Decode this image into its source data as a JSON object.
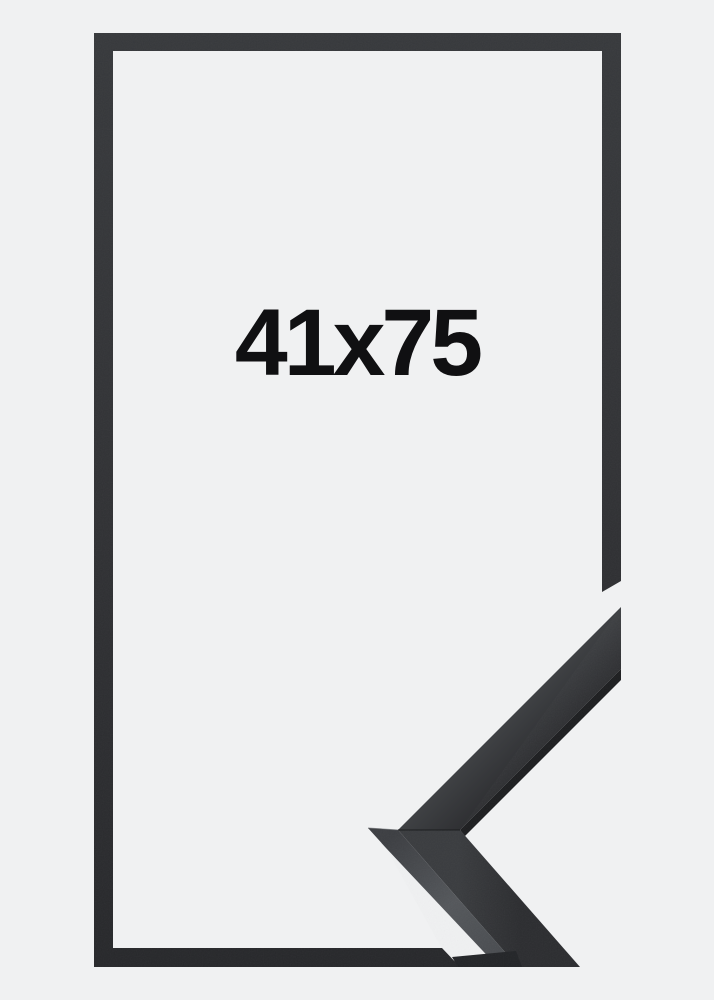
{
  "product_image": {
    "size_label": "41x75",
    "colors": {
      "background": "#f0f1f2",
      "frame_outline": "#313излишне",
      "label_text": "#101012"
    }
  }
}
